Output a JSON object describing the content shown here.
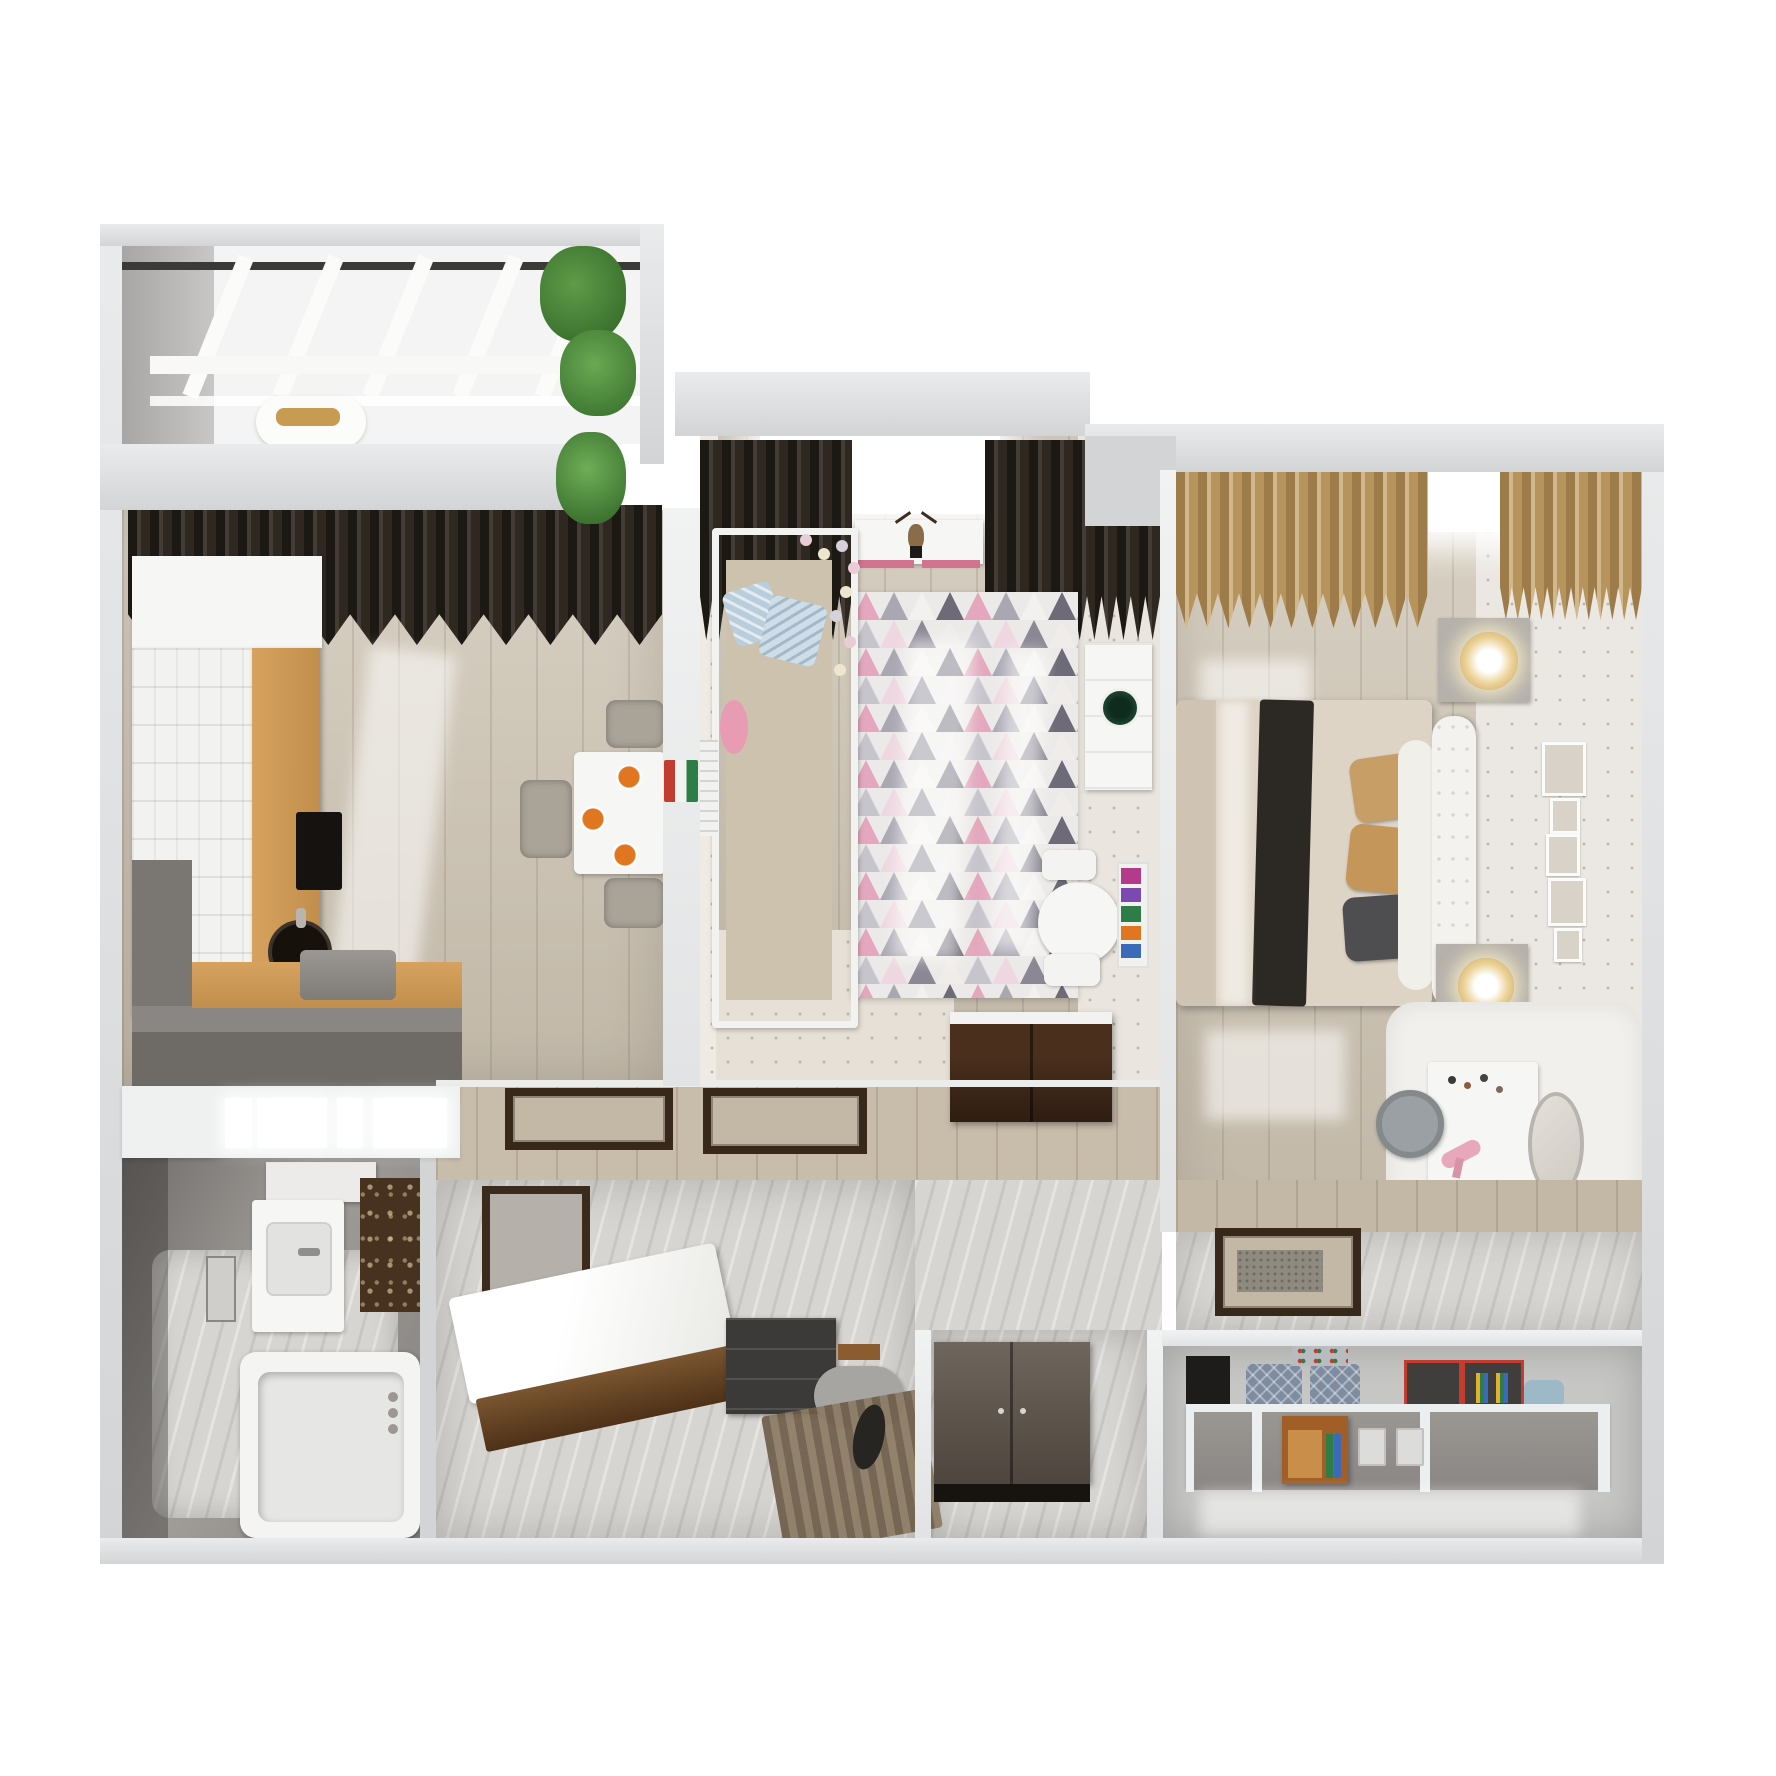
{
  "meta": {
    "title": "Apartment 3D floor plan render - top view",
    "view": "top-down dollhouse render",
    "background": "#ffffff"
  },
  "palette": {
    "wall": "#d2d4d6",
    "wallLight": "#e9ebec",
    "wallDark": "#b9bbbd",
    "floorWood": "#cdc3b2",
    "floorWoodDark": "#c3b7a6",
    "marble": "#d7d5d1",
    "marbleDark": "#93908d",
    "curtainDark": "#332c25",
    "curtainTan": "#c29f66",
    "counterWood": "#c28e4d",
    "darkWood": "#3f2a1a",
    "cabinetWood": "#a15f27",
    "bedBeige": "#ded4c6",
    "pillowTan": "#c79f66",
    "pillowBlue": "#b9cedd",
    "rugPink": "#e3a8bd",
    "rugGrey": "#a9a7b2",
    "rugDark": "#6d6b77",
    "rugLight": "#efecea",
    "accentOrange": "#e0761f",
    "accentGreen": "#1c4632",
    "accentRed": "#c23c30",
    "storageBlue": "#7e8ca0",
    "lampGold": "#c89b52",
    "plantGreen": "#4d8a3c",
    "mat": "#8f8a80"
  },
  "rooms": [
    {
      "id": "balcony",
      "name": "Balcony (glazed loggia)",
      "furniture": [
        "glazed window wall",
        "lounge chair",
        "gold cushion",
        "potted plant"
      ]
    },
    {
      "id": "kitchen",
      "name": "Kitchen",
      "furniture": [
        "dark curtains",
        "white cabinet run",
        "wood countertop",
        "black round sink",
        "cooktop",
        "grey peninsula half-wall",
        "dining table",
        "plates of food",
        "grey chairs"
      ]
    },
    {
      "id": "nursery",
      "name": "Children's room",
      "furniture": [
        "blackout curtains",
        "wall shelf with deer head",
        "white canopy crib",
        "pastel ball garland",
        "blue pillows",
        "triangle pattern rug",
        "radiator",
        "wall cabinet with green decor",
        "kids round table with chairs",
        "sling book rack",
        "dark wood dresser"
      ]
    },
    {
      "id": "bedroom",
      "name": "Bedroom",
      "furniture": [
        "tan curtains",
        "double bed",
        "dark striped throw",
        "upholstered headboard",
        "nightstands",
        "glowing lamps",
        "gallery wall frames",
        "fluffy rug",
        "vanity table with cosmetics",
        "round mirror",
        "stool",
        "door mat"
      ]
    },
    {
      "id": "bathroom",
      "name": "Bathroom",
      "furniture": [
        "frosted glass half-wall",
        "marble walls",
        "wall shelf",
        "vanity sink",
        "mirror",
        "damask accent tiles",
        "bathtub with faucet"
      ]
    },
    {
      "id": "hallway",
      "name": "Hallway",
      "furniture": [
        "white bench with wood base",
        "dark framed mirror",
        "shoe cabinet",
        "wood ledge",
        "grey pouf",
        "striped runner rug",
        "cat figurine"
      ]
    },
    {
      "id": "nook",
      "name": "Wardrobe nook",
      "furniture": [
        "two-door cabinet"
      ]
    },
    {
      "id": "storage",
      "name": "Storage room",
      "furniture": [
        "low partition shelving",
        "dark box",
        "quilted storage bags",
        "wire basket",
        "boxes with red trim",
        "wooden cabinet",
        "white storage boxes"
      ]
    }
  ]
}
